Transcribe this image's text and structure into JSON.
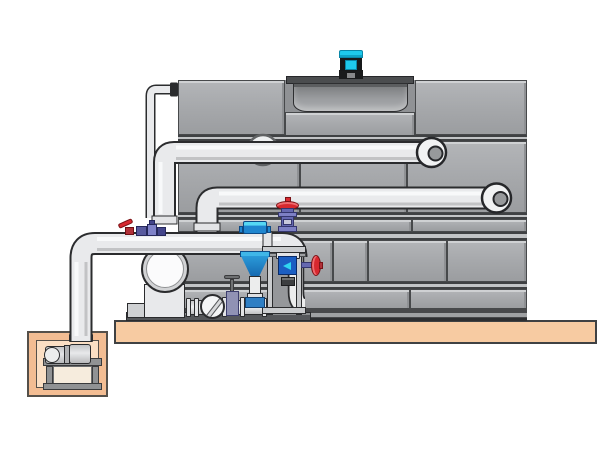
{
  "scene": {
    "type": "technical-illustration",
    "subject": "Closed-circuit cooling tower with fan motor, external piping, pump skid, hydrocyclone separator and concrete sump pit",
    "background_color": "#ffffff"
  },
  "palette": {
    "tower_panel": "#a6a8ab",
    "tower_panel_edge": "#47494b",
    "tower_base": "#48494b",
    "fan_deck": "#4b4d4f",
    "fan_shroud_dark": "#77797b",
    "motor_cyan": "#1ec9ec",
    "pipe_light": "#e9eaec",
    "pipe_outline": "#2b2c2e",
    "concrete_slab": "#f7cba2",
    "pit_concrete": "#f3bd93",
    "pit_inner": "#fbdfc4",
    "valve_red": "#d7282f",
    "valve_purple": "#6568b0",
    "separator_blue": "#1f86cf",
    "separator_cyan": "#49cdf2",
    "meter_blue": "#1b5ec2",
    "skid_gray": "#caccce"
  },
  "components": {
    "cooling_tower": {
      "name": "Cooling tower casing"
    },
    "fan_motor": {
      "name": "Fan motor"
    },
    "fan_shroud": {
      "name": "Fan shroud"
    },
    "fan_deck": {
      "name": "Fan deck plate"
    },
    "supply_pipe_upper": {
      "name": "Upper supply pipe"
    },
    "supply_pipe_middle": {
      "name": "Middle supply pipe"
    },
    "suction_pipe_lower": {
      "name": "Lower suction pipe"
    },
    "makeup_line": {
      "name": "Thin make-up water line"
    },
    "wall_flange": {
      "name": "Circular wall flange"
    },
    "elbow_ring": {
      "name": "Flanged pipe elbow"
    },
    "sump_pit": {
      "name": "Concrete sump pit"
    },
    "sump_pump": {
      "name": "Sump pump set"
    },
    "pump_stand": {
      "name": "Pump stand"
    },
    "skid_pump": {
      "name": "Circulation pump volute"
    },
    "check_valve": {
      "name": "Check valve"
    },
    "gate_valve_small": {
      "name": "Gate valve"
    },
    "globe_valve_red": {
      "name": "Globe valve with red handwheel"
    },
    "ball_valve_red": {
      "name": "Ball valve with red lever"
    },
    "handwheel_valve_side": {
      "name": "Side handwheel valve"
    },
    "separator": {
      "name": "Hydrocyclone separator"
    },
    "flow_meter": {
      "name": "Flow meter"
    },
    "equipment_frame": {
      "name": "Equipment support frame"
    },
    "dosing_manifold": {
      "name": "Dosing valve manifold"
    },
    "foundation_slab": {
      "name": "Concrete foundation slab"
    },
    "skid_base": {
      "name": "Skid base rail"
    }
  }
}
